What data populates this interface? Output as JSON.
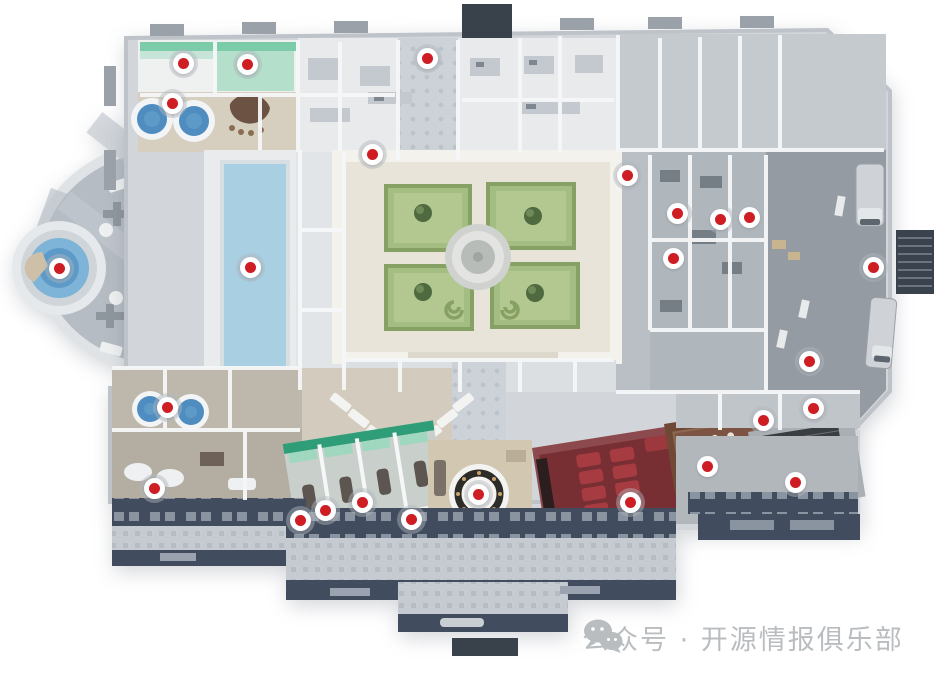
{
  "watermark": {
    "icon": "wechat-icon",
    "text": "公众号 · 开源情报俱乐部"
  },
  "palette": {
    "markerRed": "#ce1d23",
    "poolBlue": "#a8cfe2",
    "roundPoolBlue": "#7db4d8",
    "roundPoolDeep": "#5e9ac8",
    "tubBlue": "#4f8cc0",
    "gardenGreen": "#a3bd83",
    "gardenLight": "#b9cc97",
    "hedgeGreen": "#87a164",
    "treeGreen": "#4e6a3e",
    "courtyardStone": "#e8e4da",
    "theaterRed": "#772f34",
    "theaterWall": "#8d4a4e",
    "seatRed": "#a63b41",
    "diningBrown": "#6f4836",
    "rugBrown": "#7d5444",
    "tealDark": "#2f9e78",
    "tealLight": "#9fd8bf",
    "tealWall": "#7ccba9",
    "barBrown": "#6b5243",
    "stoneBeige": "#d6cfc0",
    "dockGray": "#949ba2",
    "foundationNavy": "#414c5e",
    "watermarkGray": "#b9bdc0"
  },
  "markers": [
    {
      "id": 1,
      "x": 183,
      "y": 63
    },
    {
      "id": 2,
      "x": 247,
      "y": 64
    },
    {
      "id": 3,
      "x": 172,
      "y": 103
    },
    {
      "id": 4,
      "x": 427,
      "y": 58
    },
    {
      "id": 5,
      "x": 372,
      "y": 154
    },
    {
      "id": 6,
      "x": 627,
      "y": 175
    },
    {
      "id": 7,
      "x": 677,
      "y": 213
    },
    {
      "id": 8,
      "x": 720,
      "y": 219
    },
    {
      "id": 9,
      "x": 749,
      "y": 217
    },
    {
      "id": 10,
      "x": 673,
      "y": 258
    },
    {
      "id": 11,
      "x": 873,
      "y": 267
    },
    {
      "id": 12,
      "x": 59,
      "y": 268
    },
    {
      "id": 13,
      "x": 250,
      "y": 267
    },
    {
      "id": 14,
      "x": 809,
      "y": 361
    },
    {
      "id": 15,
      "x": 813,
      "y": 408
    },
    {
      "id": 16,
      "x": 763,
      "y": 420
    },
    {
      "id": 17,
      "x": 167,
      "y": 407
    },
    {
      "id": 18,
      "x": 154,
      "y": 488
    },
    {
      "id": 19,
      "x": 300,
      "y": 520
    },
    {
      "id": 20,
      "x": 325,
      "y": 510
    },
    {
      "id": 21,
      "x": 362,
      "y": 502
    },
    {
      "id": 22,
      "x": 411,
      "y": 519
    },
    {
      "id": 23,
      "x": 478,
      "y": 494
    },
    {
      "id": 24,
      "x": 630,
      "y": 502
    },
    {
      "id": 25,
      "x": 707,
      "y": 466
    },
    {
      "id": 26,
      "x": 795,
      "y": 482
    }
  ]
}
